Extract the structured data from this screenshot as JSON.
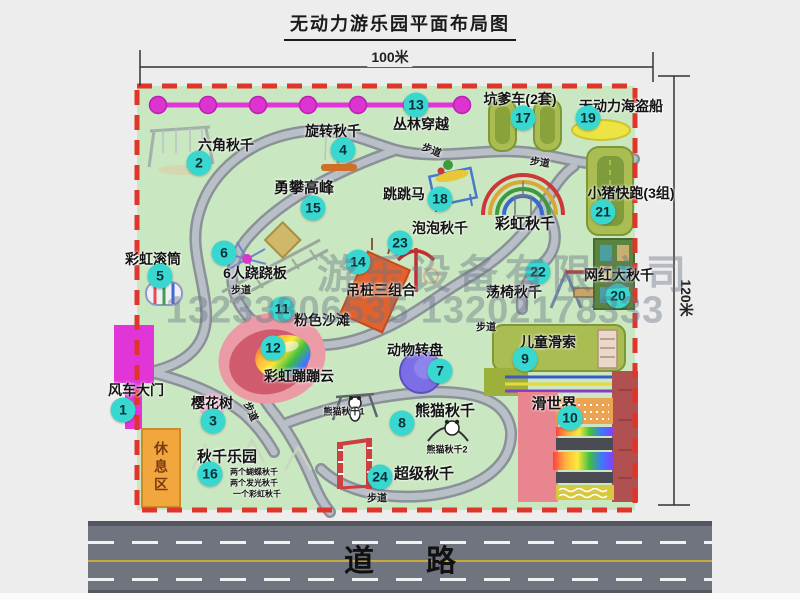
{
  "title": "无动力游乐园平面布局图",
  "dimensions": {
    "top": "100米",
    "right": "120米"
  },
  "road": {
    "label": "道路"
  },
  "rest_area": {
    "label": "休息区"
  },
  "watermark": {
    "line1": "游乐设备有限公司",
    "line2": "13233806535 13202178333"
  },
  "colors": {
    "map_green": "#c9e7c0",
    "border_red": "#e0352b",
    "marker_cyan": "#38d7d0",
    "magenta_line": "#e135d8",
    "walkway_gray": "#9aa0a8",
    "road_gray": "#70747f",
    "olive_pad": "#a9bd52",
    "rest_area_orange": "#f2a63e"
  },
  "features": [
    {
      "num": "1",
      "label": "风车大门",
      "marker": {
        "x": 123,
        "y": 410
      },
      "label_pos": {
        "x": 136,
        "y": 390
      }
    },
    {
      "num": "2",
      "label": "六角秋千",
      "marker": {
        "x": 199,
        "y": 163
      },
      "label_pos": {
        "x": 226,
        "y": 145
      }
    },
    {
      "num": "3",
      "label": "樱花树",
      "marker": {
        "x": 213,
        "y": 421
      },
      "label_pos": {
        "x": 212,
        "y": 403
      }
    },
    {
      "num": "4",
      "label": "旋转秋千",
      "marker": {
        "x": 343,
        "y": 150
      },
      "label_pos": {
        "x": 333,
        "y": 131
      }
    },
    {
      "num": "5",
      "label": "彩虹滚筒",
      "marker": {
        "x": 160,
        "y": 276
      },
      "label_pos": {
        "x": 153,
        "y": 259
      }
    },
    {
      "num": "6",
      "label": "6人跷跷板",
      "marker": {
        "x": 224,
        "y": 253
      },
      "label_pos": {
        "x": 255,
        "y": 273
      }
    },
    {
      "num": "7",
      "label": "动物转盘",
      "marker": {
        "x": 440,
        "y": 371
      },
      "label_pos": {
        "x": 415,
        "y": 350
      }
    },
    {
      "num": "8",
      "label": "熊猫秋千",
      "marker": {
        "x": 402,
        "y": 423
      },
      "label_pos": {
        "x": 445,
        "y": 410
      },
      "fs": 15
    },
    {
      "num": "9",
      "label": "儿童滑索",
      "marker": {
        "x": 525,
        "y": 359
      },
      "label_pos": {
        "x": 548,
        "y": 342
      }
    },
    {
      "num": "10",
      "label": "滑世界",
      "marker": {
        "x": 570,
        "y": 418
      },
      "label_pos": {
        "x": 554,
        "y": 403
      },
      "fs": 15
    },
    {
      "num": "11",
      "label": "粉色沙滩",
      "marker": {
        "x": 282,
        "y": 309
      },
      "label_pos": {
        "x": 322,
        "y": 320
      }
    },
    {
      "num": "12",
      "label": "彩虹蹦蹦云",
      "marker": {
        "x": 273,
        "y": 348
      },
      "label_pos": {
        "x": 299,
        "y": 376
      }
    },
    {
      "num": "13",
      "label": "丛林穿越",
      "marker": {
        "x": 416,
        "y": 105
      },
      "label_pos": {
        "x": 421,
        "y": 124
      }
    },
    {
      "num": "14",
      "label": "吊桩三组合",
      "marker": {
        "x": 358,
        "y": 262
      },
      "label_pos": {
        "x": 381,
        "y": 290
      }
    },
    {
      "num": "15",
      "label": "勇攀高峰",
      "marker": {
        "x": 313,
        "y": 208
      },
      "label_pos": {
        "x": 304,
        "y": 187
      },
      "fs": 15
    },
    {
      "num": "16",
      "label": "秋千乐园",
      "marker": {
        "x": 210,
        "y": 474
      },
      "label_pos": {
        "x": 227,
        "y": 456
      },
      "fs": 15
    },
    {
      "num": "17",
      "label": "坑爹车(2套)",
      "marker": {
        "x": 523,
        "y": 118
      },
      "label_pos": {
        "x": 520,
        "y": 99
      }
    },
    {
      "num": "18",
      "label": "跳跳马",
      "marker": {
        "x": 440,
        "y": 199
      },
      "label_pos": {
        "x": 404,
        "y": 194
      }
    },
    {
      "num": "19",
      "label": "无动力海盗船",
      "marker": {
        "x": 588,
        "y": 118
      },
      "label_pos": {
        "x": 621,
        "y": 106
      }
    },
    {
      "num": "20",
      "label": "网红大秋千",
      "marker": {
        "x": 618,
        "y": 296
      },
      "label_pos": {
        "x": 619,
        "y": 275
      }
    },
    {
      "num": "21",
      "label": "小猪快跑(3组)",
      "marker": {
        "x": 603,
        "y": 212
      },
      "label_pos": {
        "x": 631,
        "y": 193
      }
    },
    {
      "num": "22",
      "label": "荡椅秋千",
      "marker": {
        "x": 538,
        "y": 272
      },
      "label_pos": {
        "x": 514,
        "y": 292
      }
    },
    {
      "num": "23",
      "label": "泡泡秋千",
      "marker": {
        "x": 400,
        "y": 243
      },
      "label_pos": {
        "x": 440,
        "y": 228
      }
    },
    {
      "num": "24",
      "label": "超级秋千",
      "marker": {
        "x": 380,
        "y": 477
      },
      "label_pos": {
        "x": 424,
        "y": 473
      },
      "fs": 15
    }
  ],
  "extra_labels": [
    {
      "name": "rainbow-swing-label",
      "text": "彩虹秋千",
      "x": 525,
      "y": 223,
      "fs": 15
    },
    {
      "name": "panda-swing-1-label",
      "text": "熊猫秋千1",
      "x": 344,
      "y": 411,
      "fs": 9
    },
    {
      "name": "panda-swing-2-label",
      "text": "熊猫秋千2",
      "x": 447,
      "y": 449,
      "fs": 9
    },
    {
      "name": "swing-park-note-1",
      "text": "两个蝴蝶秋千",
      "x": 254,
      "y": 472,
      "fs": 8
    },
    {
      "name": "swing-park-note-2",
      "text": "两个发光秋千",
      "x": 254,
      "y": 483,
      "fs": 8
    },
    {
      "name": "swing-park-note-3",
      "text": "一个彩虹秋千",
      "x": 257,
      "y": 494,
      "fs": 8
    },
    {
      "name": "walkway-label",
      "text": "步道",
      "x": 432,
      "y": 149,
      "fs": 10,
      "rot": 22
    },
    {
      "name": "walkway-label",
      "text": "步道",
      "x": 540,
      "y": 161,
      "fs": 10,
      "rot": 8
    },
    {
      "name": "walkway-label",
      "text": "步道",
      "x": 241,
      "y": 289,
      "fs": 10
    },
    {
      "name": "walkway-label",
      "text": "步道",
      "x": 252,
      "y": 411,
      "fs": 10,
      "rot": 65
    },
    {
      "name": "walkway-label",
      "text": "步道",
      "x": 486,
      "y": 326,
      "fs": 10
    },
    {
      "name": "walkway-label",
      "text": "步道",
      "x": 377,
      "y": 497,
      "fs": 10
    }
  ]
}
